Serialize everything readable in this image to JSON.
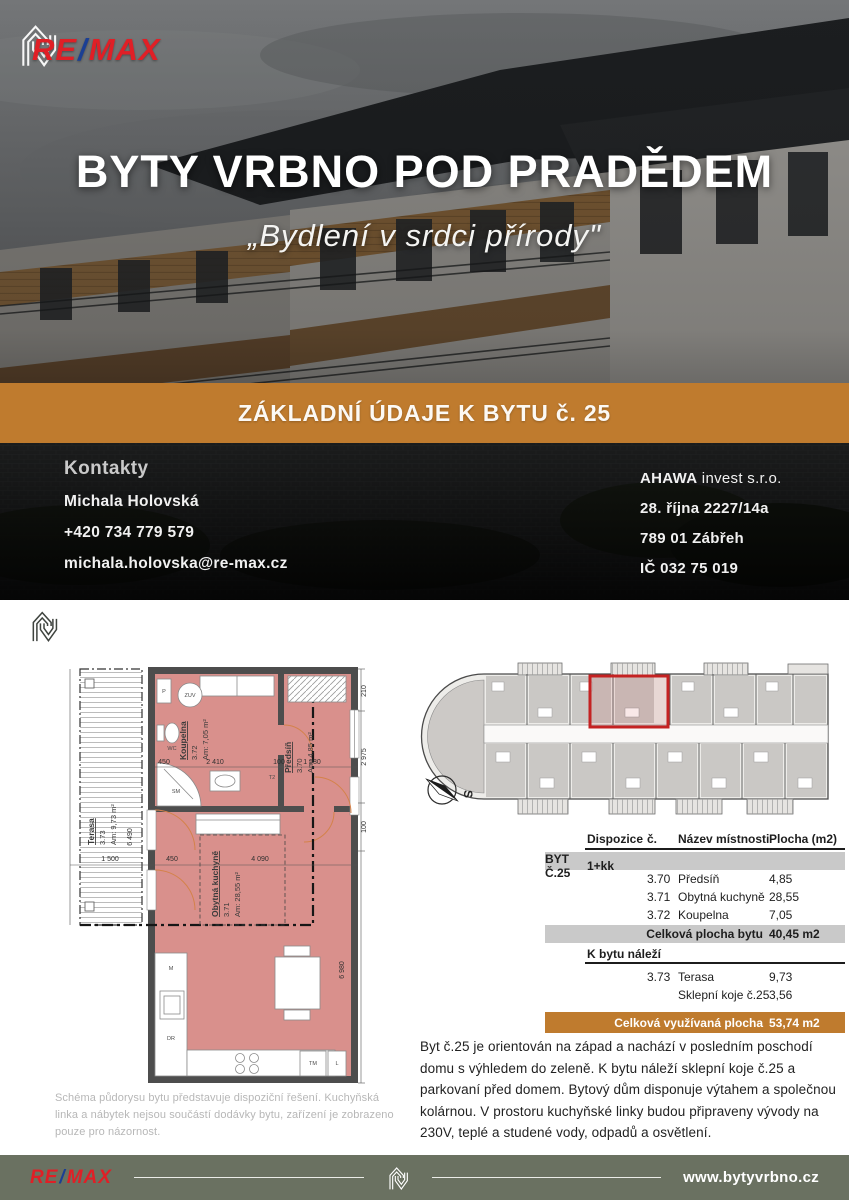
{
  "brand": {
    "re": "RE",
    "slash": "/",
    "max": "MAX"
  },
  "hero": {
    "title": "BYTY VRBNO POD PRADĚDEM",
    "subtitle": "„Bydlení v srdci přírody\"",
    "banner": "ZÁKLADNÍ ÚDAJE K BYTU č. 25"
  },
  "contacts": {
    "heading": "Kontakty",
    "name": "Michala Holovská",
    "phone": "+420 734 779 579",
    "email": "michala.holovska@re-max.cz",
    "company_name": "AHAWA",
    "company_suffix": " invest s.r.o.",
    "address_line1": "28. října 2227/14a",
    "address_line2": "789 01 Zábřeh",
    "company_id": "IČ 032 75 019"
  },
  "section_header": {
    "title": "ZÁKLADNÍ INFORMACE",
    "unit": "Byt č.25"
  },
  "floorplan": {
    "terrace": {
      "name": "Terasa",
      "number": "3.73",
      "area": "Am: 9,73 m²"
    },
    "bathroom": {
      "name": "Koupelna",
      "number": "3.72",
      "area": "Am: 7,05 m²"
    },
    "hall": {
      "name": "Předsíň",
      "number": "3.70",
      "area": "Am: 4,85 m²"
    },
    "kitchen": {
      "name": "Obytná kuchyně",
      "number": "3.71",
      "area": "Am: 28,55 m²"
    },
    "dims": {
      "d6490": "6 490",
      "d1500": "1 500",
      "d450a": "450",
      "d2410": "2 410",
      "d100a": "100",
      "d1580": "1 580",
      "d210": "210",
      "d2975": "2 975",
      "d100b": "100",
      "d4090": "4 090",
      "d450b": "450",
      "d6980": "6 980"
    },
    "appliances": {
      "p": "P",
      "zuv": "ZUV",
      "wc": "WC",
      "sm": "SM",
      "t2": "T2",
      "m": "M",
      "dr": "DR",
      "tm": "TM",
      "l": "L"
    },
    "compass_label": "S"
  },
  "table": {
    "headers": [
      "Dispozice",
      "č.",
      "Název místnosti",
      "Plocha (m2)"
    ],
    "unit_row": {
      "label": "BYT Č.25",
      "layout": "1+kk"
    },
    "rooms": [
      {
        "num": "3.70",
        "name": "Předsíň",
        "area": "4,85"
      },
      {
        "num": "3.71",
        "name": "Obytná kuchyně",
        "area": "28,55"
      },
      {
        "num": "3.72",
        "name": "Koupelna",
        "area": "7,05"
      }
    ],
    "total_row": {
      "label": "Celková plocha bytu",
      "value": "40,45 m2"
    },
    "belongs_label": "K bytu náleží",
    "extras": [
      {
        "num": "3.73",
        "name": "Terasa",
        "area": "9,73"
      },
      {
        "num": "",
        "name": "Sklepní koje č.25",
        "area": "3,56"
      }
    ],
    "grand_total": {
      "label": "Celková využívaná plocha",
      "value": "53,74 m2"
    }
  },
  "description": "Byt č.25 je orientován na západ a nachází v posledním poschodí domu s výhledem do zeleně. K bytu náleží sklepní koje č.25 a parkovaní před domem. Bytový dům disponuje výtahem a společnou kolárnou. V prostoru kuchyňské linky budou připraveny vývody na 230V, teplé a studené vody, odpadů a osvětlení.",
  "footnote": "Schéma půdorysu bytu představuje dispoziční řešení. Kuchyňská linka a nábytek nejsou součástí dodávky bytu, zařízení je zobrazeno pouze pro názornost.",
  "footer": {
    "website": "www.bytyvrbno.cz"
  },
  "colors": {
    "gold": "#bf7b2e",
    "footer_green": "#6a7161",
    "room_fill": "#d9908c",
    "wall_gray": "#4d4d4d",
    "remax_red": "#e01f26",
    "remax_blue": "#1b3f94",
    "highlight_red": "#c42222",
    "table_row_gray": "#c9c9c9"
  }
}
